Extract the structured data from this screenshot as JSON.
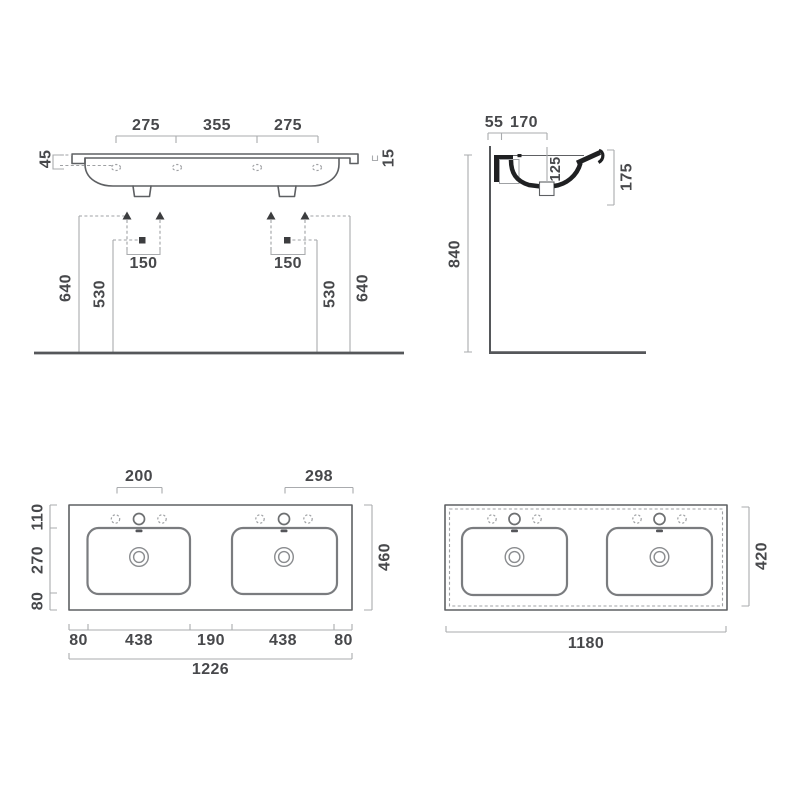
{
  "colors": {
    "background": "#ffffff",
    "outline_gray": "#5e6063",
    "section_black": "#1f2022",
    "dimension_line_gray": "#a9abae",
    "dimension_text_gray": "#47484b"
  },
  "front_view": {
    "tap_spacings": [
      "275",
      "355",
      "275"
    ],
    "rim_edge_height": "45",
    "rim_thickness": "15",
    "anchor_spacing": "150",
    "outer_height": "640",
    "inner_height": "530"
  },
  "side_view": {
    "back_offset": "55",
    "front_offset": "170",
    "bowl_depth": "125",
    "front_apron_height": "175",
    "mounting_height": "840"
  },
  "plan_view": {
    "tap_group_width": "200",
    "tap_to_edge": "298",
    "side_dims": [
      "110",
      "270",
      "80"
    ],
    "overall_depth": "460",
    "bottom_dims": [
      "80",
      "438",
      "190",
      "438",
      "80"
    ],
    "overall_width": "1226"
  },
  "cutout_view": {
    "depth": "420",
    "width": "1180"
  }
}
